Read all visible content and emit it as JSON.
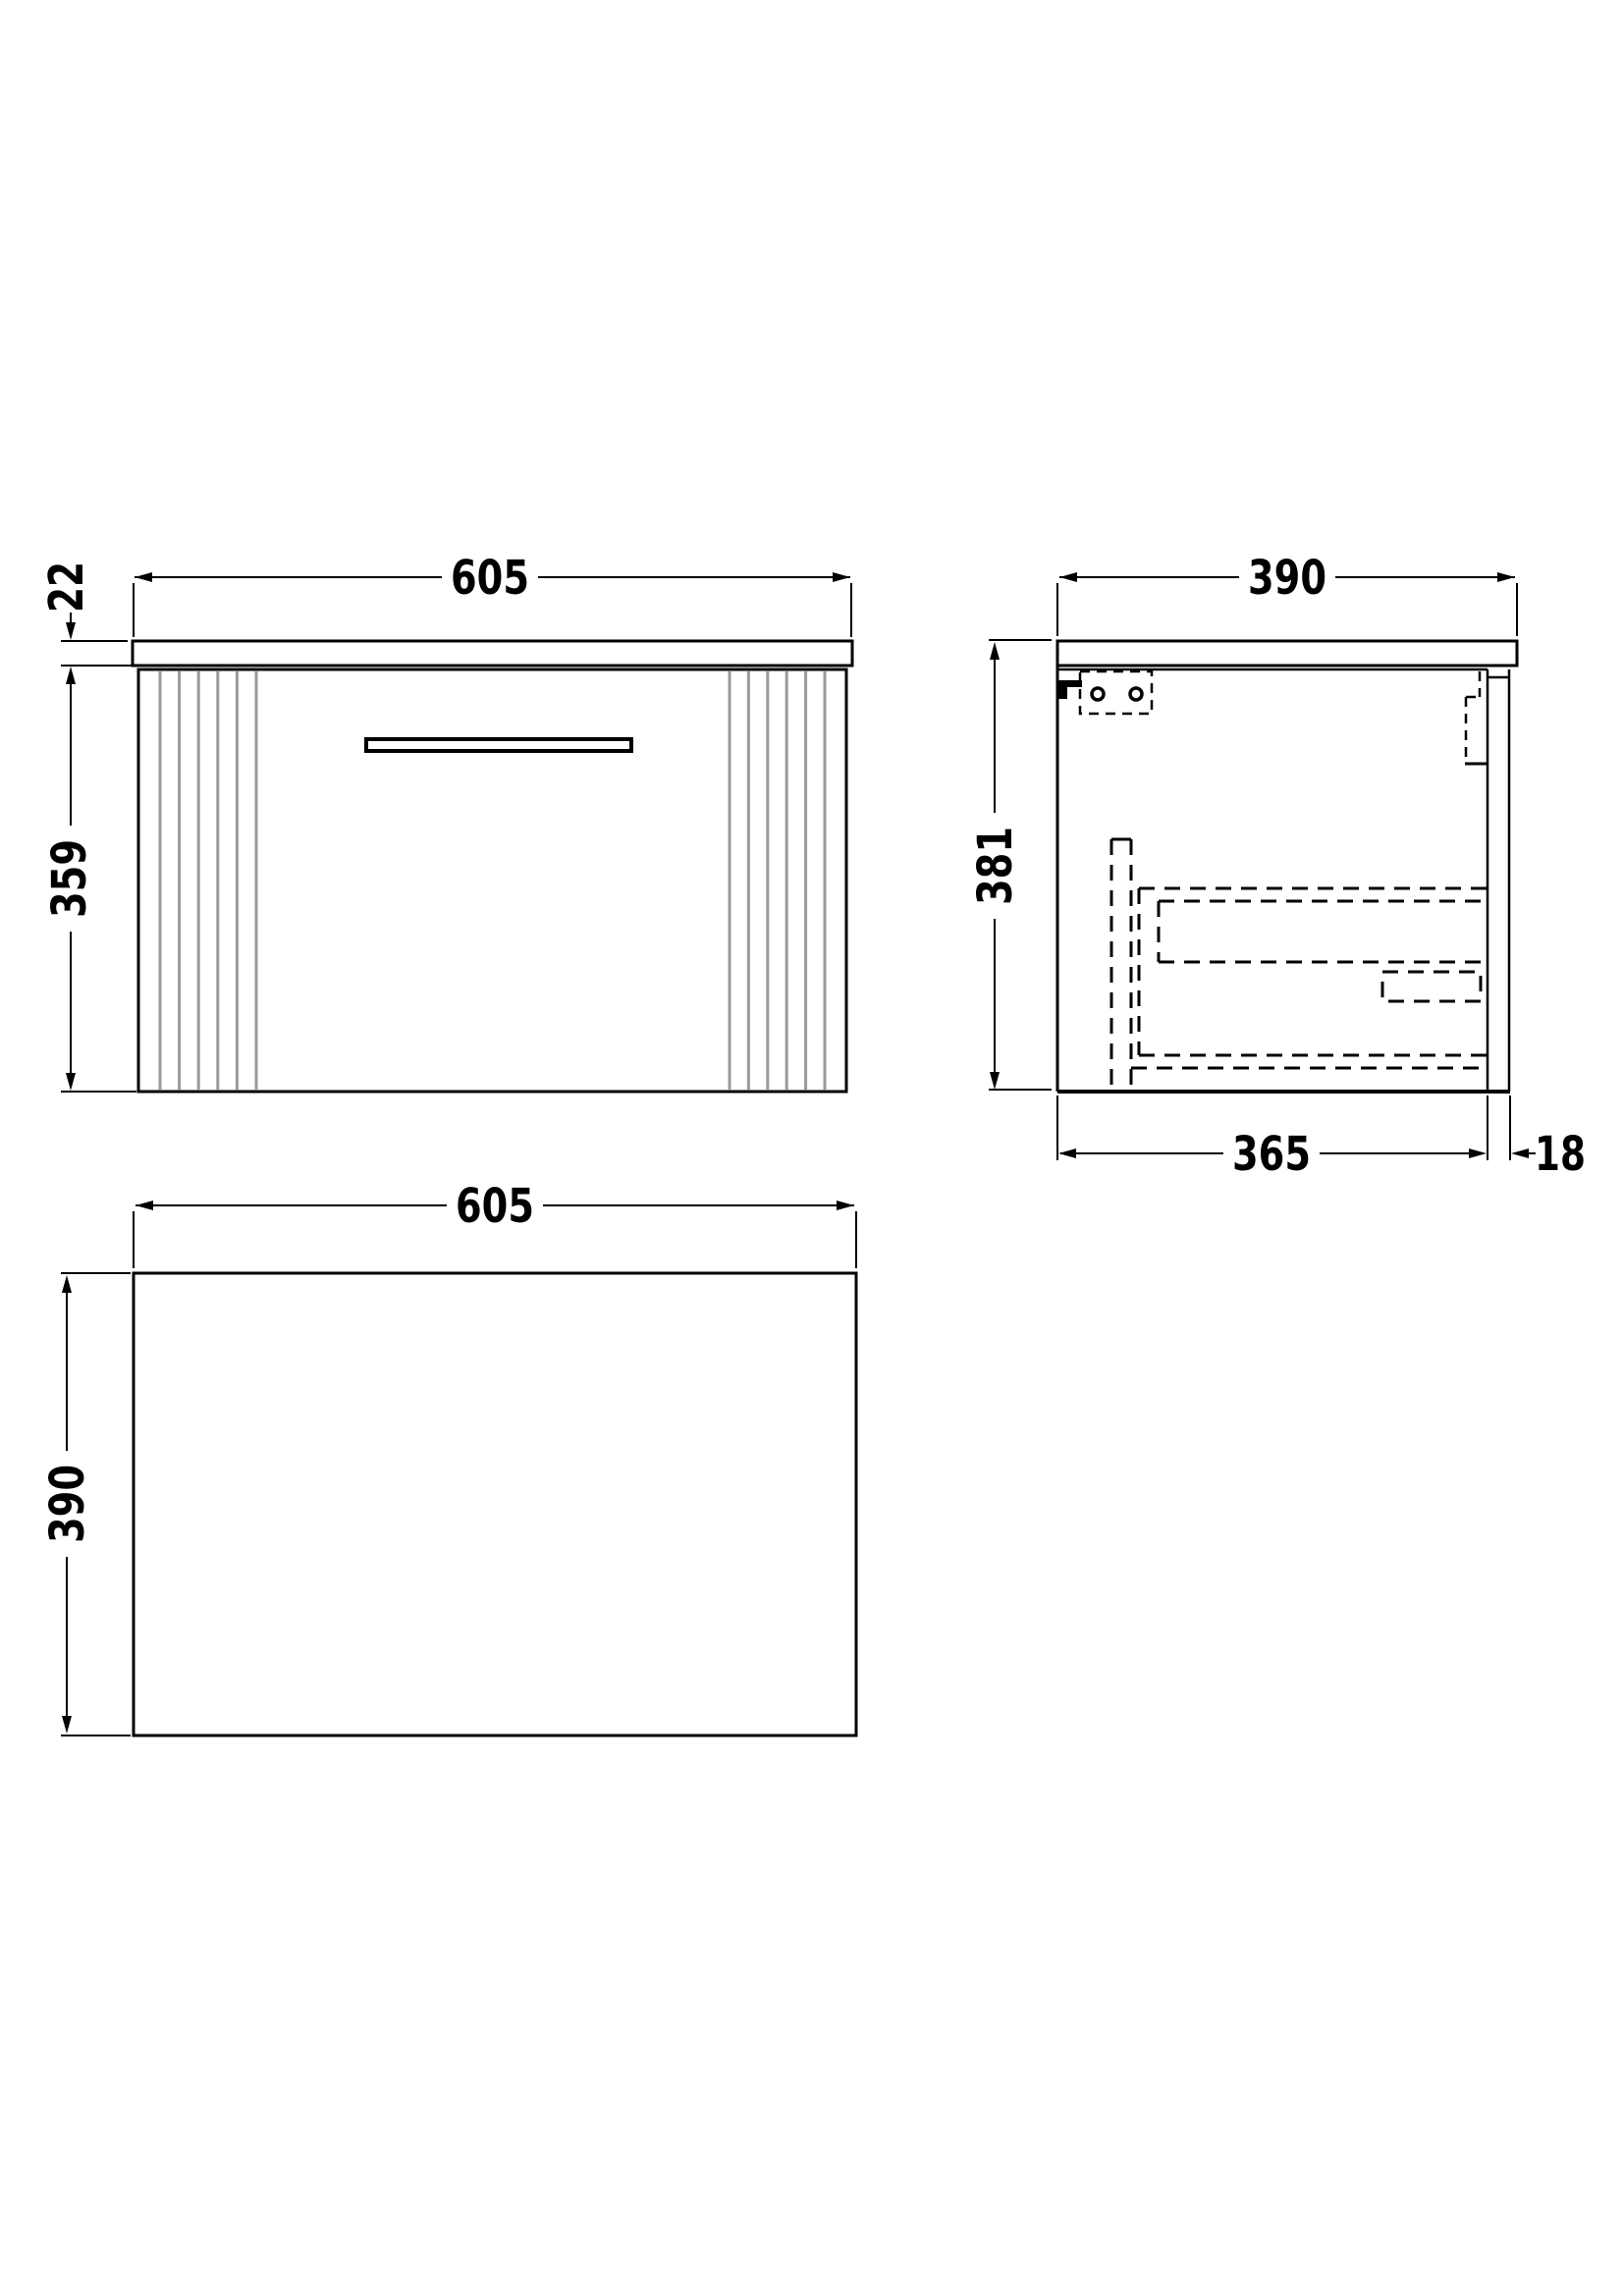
{
  "drawing": {
    "type": "technical-orthographic-drawing",
    "background": "#ffffff",
    "line_color": "#000000",
    "flute_line_color": "#9a9a9a"
  },
  "views": {
    "front": {
      "width": "605",
      "worktop_thickness": "22",
      "cabinet_height": "359"
    },
    "side": {
      "depth": "390",
      "height": "381",
      "internal_depth": "365",
      "back_panel_thickness": "18"
    },
    "plan": {
      "width": "605",
      "depth": "390"
    }
  }
}
